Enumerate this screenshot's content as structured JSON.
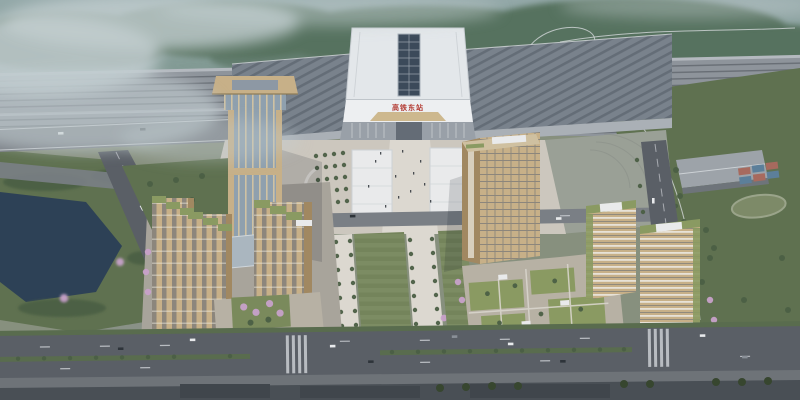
{
  "scene": {
    "title": "Aerial architectural rendering of a high-speed railway station district",
    "description": "Bird's-eye rendering: a large railway station with ribbed roof, rooftop solar strip and red Chinese name sign; rail tracks and misty forested hills behind; landmark tower and beige residential cluster with pink blossom trees on the left; office cluster with green roofs on the right; central lawn axis, lake, boulevards with cars and street trees.",
    "station_sign": "高铁东站"
  },
  "colors": {
    "sky_top": "#93a8a8",
    "hills": "#6d897b",
    "forest": "#57725f",
    "mist": "#c2cdd0",
    "track_bed": "#8e949b",
    "track_line": "#5f646c",
    "viaduct": "#b4b9bf",
    "wing_roof": "#79828c",
    "wing_rib": "#4f5761",
    "station_roof": "#e3e7ea",
    "station_wall": "#edeff1",
    "solar": "#3c4a5a",
    "sign_red": "#b23830",
    "gold_canopy": "#cdb88e",
    "entrance": "#99a0a8",
    "plaza": "#ccc7be",
    "plaza_light": "#dcd8d0",
    "parking": "#9aa096",
    "lawn": "#74845b",
    "lawn_light": "#83926a",
    "green_dark": "#596c4e",
    "tree": "#4b5f45",
    "blossom": "#c7a1c9",
    "bank": "#5f7150",
    "road": "#5a5f66",
    "road_light": "#7a7f85",
    "lane": "#c9ccd1",
    "sidewalk": "#6e7378",
    "beige": "#c7b088",
    "beige_dark": "#a18861",
    "window": "#5a6472",
    "glass": "#8fa0ae",
    "mullion": "#d6c6a2",
    "green_roof": "#8a9a62",
    "white_roof": "#e9eaeb",
    "deck": "#b7b1a4",
    "storefront": "#8a8176",
    "lake": "#2d4156",
    "field_gray": "#909790",
    "warehouse": "#9da3a9",
    "court_red": "#a76a5e",
    "court_blue": "#5c7f9a",
    "car_white": "#e8eaec",
    "car_dark": "#2e343a"
  }
}
